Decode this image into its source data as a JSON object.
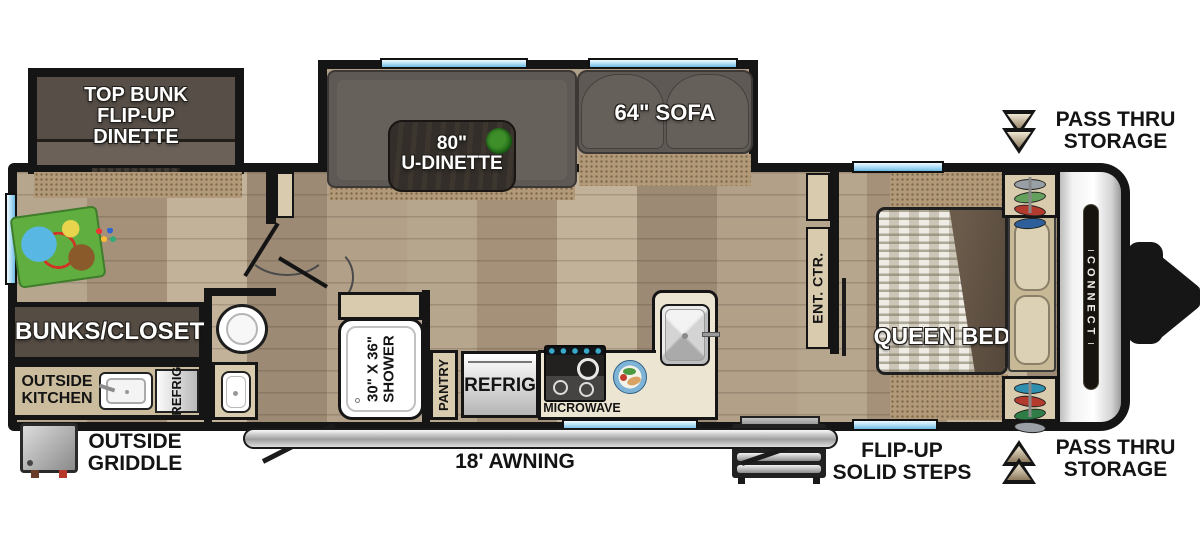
{
  "colors": {
    "wall": "#151515",
    "window": "#aadcf5",
    "carpet": "#b29a79",
    "wood": "#b3a28a",
    "furniture": "#5e5955",
    "cabinet-tan": "#d9cbae",
    "arrow-accent": "#a08b6d"
  },
  "slideouts": {
    "bunk_label": "TOP BUNK\nFLIP-UP\nDINETTE",
    "dinette_label": "80\"\nU-DINETTE",
    "sofa_label": "64\" SOFA"
  },
  "living": {
    "bunks_closet": "BUNKS/CLOSET"
  },
  "outside_kitchen": {
    "label": "OUTSIDE\nKITCHEN",
    "refrig": "REFRIG",
    "griddle": "OUTSIDE\nGRIDDLE"
  },
  "bath": {
    "shower": "30\" X 36\"\nSHOWER"
  },
  "kitchen": {
    "pantry": "PANTRY",
    "refrig": "REFRIG",
    "microwave": "MICROWAVE"
  },
  "bedroom": {
    "bed": "QUEEN BED",
    "ent_ctr": "ENT. CTR."
  },
  "exterior": {
    "awning": "18' AWNING",
    "steps": "FLIP-UP\nSOLID STEPS",
    "pass_thru_top": "PASS THRU\nSTORAGE",
    "pass_thru_bottom": "PASS THRU\nSTORAGE",
    "brand_badge": "CONNECT"
  }
}
